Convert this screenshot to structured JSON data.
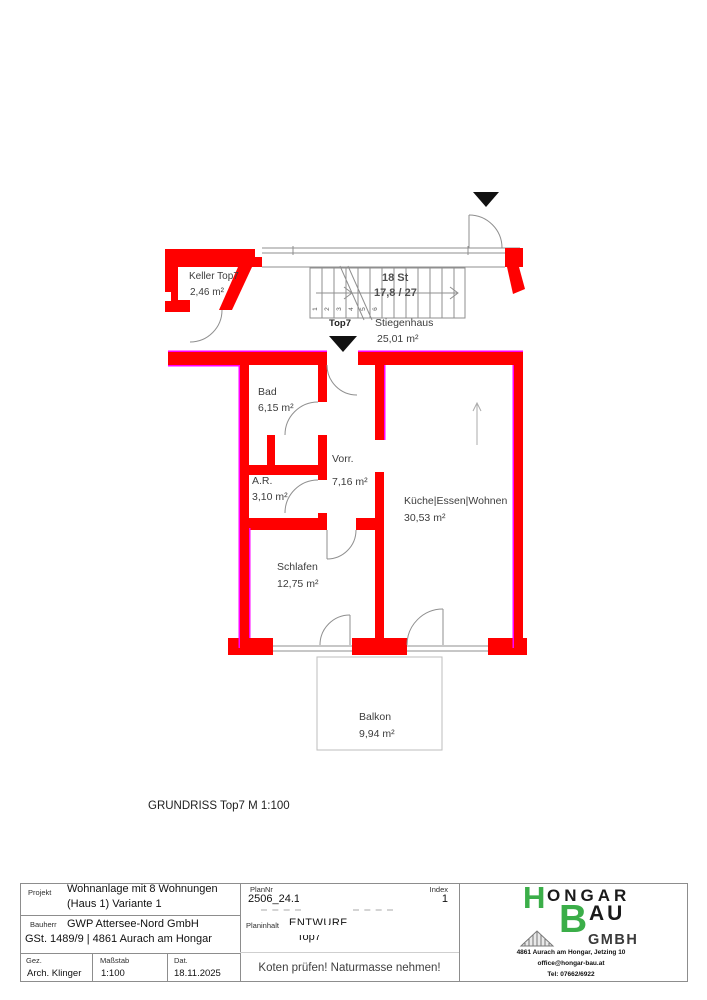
{
  "colors": {
    "wall_red": "#ff0000",
    "accent_magenta": "#ff00ff",
    "logo_green": "#3bae49",
    "line_gray": "#8f8f8f"
  },
  "plan": {
    "keller": {
      "name": "Keller Top7",
      "area": "2,46 m²"
    },
    "stairs": {
      "count_label": "18 St",
      "dim_label": "17,8 / 27",
      "tread_numbers": [
        "1",
        "2",
        "3",
        "4",
        "5",
        "6"
      ]
    },
    "entrance_label": "Top7",
    "stiegenhaus": {
      "name": "Stiegenhaus",
      "area": "25,01 m²"
    },
    "rooms": [
      {
        "name": "Bad",
        "area": "6,15 m²"
      },
      {
        "name": "A.R.",
        "area": "3,10 m²"
      },
      {
        "name": "Vorr.",
        "area": "7,16 m²"
      },
      {
        "name": "Küche|Essen|Wohnen",
        "area": "30,53 m²"
      },
      {
        "name": "Schlafen",
        "area": "12,75 m²"
      },
      {
        "name": "Balkon",
        "area": "9,94 m²"
      }
    ],
    "caption": "GRUNDRISS Top7 M 1:100"
  },
  "titleblock": {
    "projekt_label": "Projekt",
    "projekt_line1": "Wohnanlage mit 8 Wohnungen",
    "projekt_line2": "(Haus 1) Variante 1",
    "plannr_label": "PlanNr",
    "plannr_value": "2506_24.18",
    "index_label": "Index",
    "index_value": "1",
    "bauherr_label": "Bauherr",
    "bauherr_line1": "GWP Attersee-Nord GmbH",
    "bauherr_line2": "GSt. 1489/9 | 4861 Aurach am Hongar",
    "planinhalt_label": "Planinhalt",
    "planinhalt_line1": "ENTWURF",
    "planinhalt_line2": "Top7",
    "gez_label": "Gez.",
    "gez_value": "Arch. Klinger",
    "massstab_label": "Maßstab",
    "massstab_value": "1:100",
    "dat_label": "Dat.",
    "dat_value": "18.11.2025",
    "note": "Koten prüfen! Naturmasse nehmen!",
    "logo": {
      "h": "H",
      "ongar": "ONGAR",
      "b": "B",
      "au": "AU",
      "gmbh": "GMBH",
      "address": "4861 Aurach am Hongar, Jetzing 10",
      "email": "office@hongar-bau.at",
      "tel": "Tel: 07662/6922"
    }
  }
}
